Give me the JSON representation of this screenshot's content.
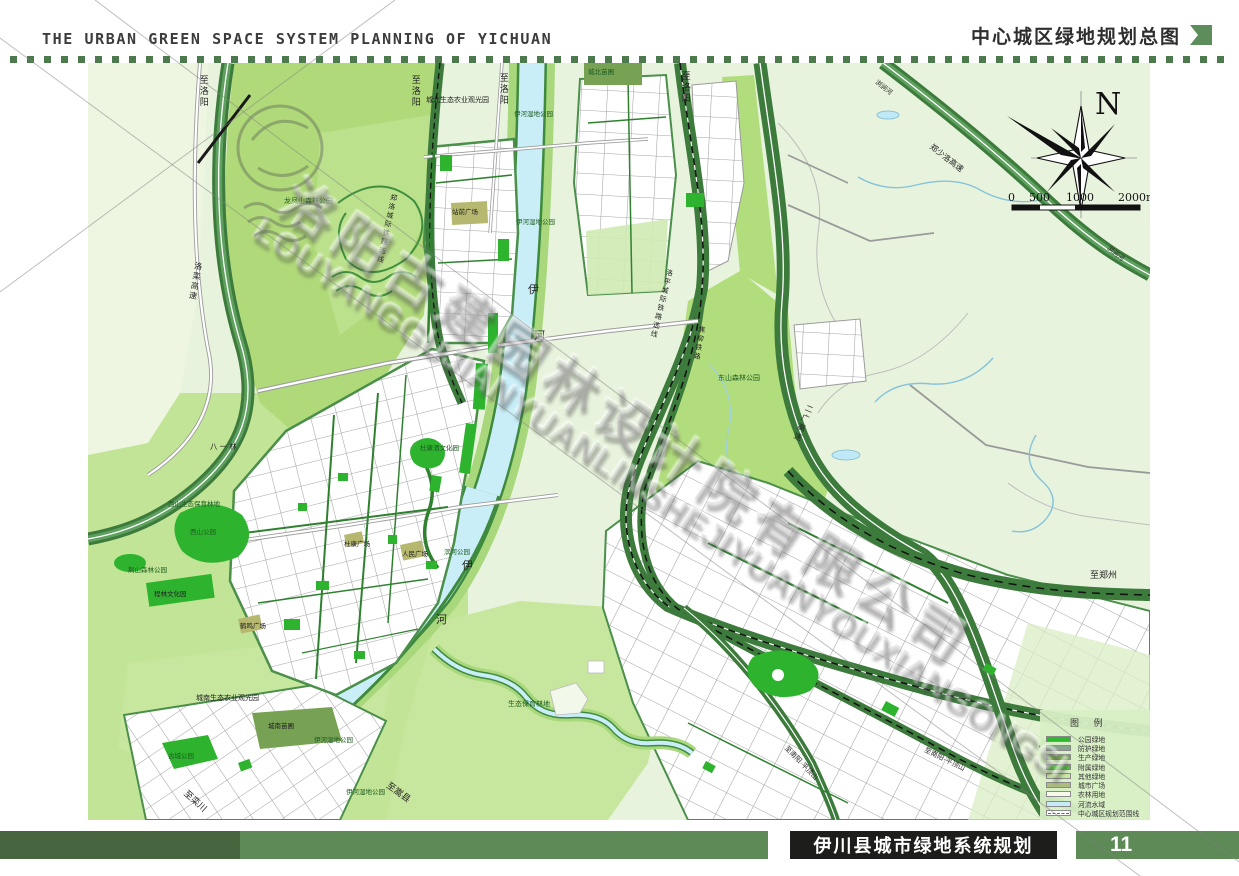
{
  "header": {
    "title_en": "THE URBAN GREEN SPACE SYSTEM PLANNING OF YICHUAN",
    "title_cn": "中心城区绿地规划总图"
  },
  "footer": {
    "title": "伊川县城市绿地系统规划",
    "page_number": "11"
  },
  "compass": {
    "label": "N"
  },
  "scale_bar": {
    "t0": "0",
    "t1": "500",
    "t2": "1000",
    "t3": "2000m"
  },
  "watermark": {
    "text_cn": "洛阳古建园林设计院有限公司",
    "text_en": "LOUYANGGUJIANYUANLINSHEJIYUANYOUXIANGONGSI"
  },
  "legend": {
    "title": "图 例",
    "items": [
      {
        "label": "公园绿地",
        "color": "#2db82f"
      },
      {
        "label": "防护绿地",
        "color": "#86a68b"
      },
      {
        "label": "生产绿地",
        "color": "#77a254"
      },
      {
        "label": "附属绿地",
        "color": "#5bc447"
      },
      {
        "label": "其他绿地",
        "color": "#c9e6a2"
      },
      {
        "label": "城市广场",
        "color": "#abbc80"
      },
      {
        "label": "农林用地",
        "color": "#f7faeb"
      },
      {
        "label": "河流水域",
        "color": "#c5ebf8"
      },
      {
        "label": "中心城区规划范围线",
        "color": "#e03636",
        "type": "line"
      }
    ]
  },
  "map": {
    "labels": [
      {
        "t": "至洛阳",
        "x": 110,
        "y": 12,
        "v": 1,
        "s": 9
      },
      {
        "t": "至洛阳",
        "x": 322,
        "y": 12,
        "v": 1,
        "s": 9
      },
      {
        "t": "至洛阳",
        "x": 410,
        "y": 10,
        "v": 1,
        "s": 9
      },
      {
        "t": "至洛阳",
        "x": 592,
        "y": 8,
        "v": 1,
        "s": 9
      },
      {
        "t": "龙凤山森林公园",
        "x": 196,
        "y": 135,
        "s": 7,
        "c": "g"
      },
      {
        "t": "城北苗圃",
        "x": 500,
        "y": 6,
        "s": 6.5,
        "c": "g"
      },
      {
        "t": "城北生态农业观光园",
        "x": 338,
        "y": 34,
        "s": 7
      },
      {
        "t": "伊河湿地公园",
        "x": 426,
        "y": 48,
        "s": 6.5,
        "c": "g"
      },
      {
        "t": "郑洛城际铁路选线",
        "x": 302,
        "y": 130,
        "v": 1,
        "r": 12,
        "s": 7
      },
      {
        "t": "站前广场",
        "x": 364,
        "y": 146,
        "s": 6.5
      },
      {
        "t": "伊河湿地公园",
        "x": 428,
        "y": 156,
        "s": 6.5,
        "c": "g"
      },
      {
        "t": "伊",
        "x": 440,
        "y": 222,
        "s": 11
      },
      {
        "t": "河",
        "x": 446,
        "y": 268,
        "s": 11
      },
      {
        "t": "洛栾高速",
        "x": 106,
        "y": 198,
        "v": 1,
        "r": 10,
        "s": 8
      },
      {
        "t": "洛平城际铁路选线",
        "x": 578,
        "y": 205,
        "v": 1,
        "r": 14,
        "s": 7
      },
      {
        "t": "焦柳铁路",
        "x": 610,
        "y": 262,
        "v": 1,
        "r": 10,
        "s": 7
      },
      {
        "t": "东山森林公园",
        "x": 630,
        "y": 312,
        "s": 7,
        "c": "g"
      },
      {
        "t": "二广高速",
        "x": 718,
        "y": 340,
        "v": 1,
        "r": 22,
        "s": 8
      },
      {
        "t": "郑少洛高速",
        "x": 845,
        "y": 80,
        "r": 38,
        "s": 8
      },
      {
        "t": "浏涧河",
        "x": 790,
        "y": 16,
        "r": 38,
        "s": 6.5
      },
      {
        "t": "浏涧河",
        "x": 1022,
        "y": 182,
        "r": 38,
        "s": 6.5
      },
      {
        "t": "八 一 林",
        "x": 122,
        "y": 380,
        "s": 7.5
      },
      {
        "t": "西山生态保育林地",
        "x": 80,
        "y": 438,
        "s": 6.5,
        "c": "g"
      },
      {
        "t": "西山公园",
        "x": 102,
        "y": 466,
        "s": 6.5,
        "c": "g"
      },
      {
        "t": "荆山森林公园",
        "x": 40,
        "y": 504,
        "s": 6.5,
        "c": "g"
      },
      {
        "t": "程林文化园",
        "x": 66,
        "y": 528,
        "s": 6.5
      },
      {
        "t": "杜康酒文化园",
        "x": 332,
        "y": 382,
        "s": 6.5,
        "c": "g"
      },
      {
        "t": "杜康广场",
        "x": 256,
        "y": 478,
        "s": 6.5
      },
      {
        "t": "人民广场",
        "x": 314,
        "y": 488,
        "s": 6.5
      },
      {
        "t": "滨河公园",
        "x": 356,
        "y": 486,
        "s": 6.5,
        "c": "g"
      },
      {
        "t": "伊",
        "x": 374,
        "y": 498,
        "s": 11
      },
      {
        "t": "河",
        "x": 348,
        "y": 552,
        "s": 11
      },
      {
        "t": "鹤鸣广场",
        "x": 152,
        "y": 560,
        "s": 6.5
      },
      {
        "t": "城南生态农业观光园",
        "x": 108,
        "y": 632,
        "s": 7
      },
      {
        "t": "城南苗圃",
        "x": 180,
        "y": 660,
        "s": 6.5
      },
      {
        "t": "伊河湿地公园",
        "x": 226,
        "y": 674,
        "s": 6.5,
        "c": "g"
      },
      {
        "t": "伊河湿地公园",
        "x": 258,
        "y": 726,
        "s": 6.5,
        "c": "g"
      },
      {
        "t": "古城公园",
        "x": 80,
        "y": 690,
        "s": 6.5,
        "c": "g"
      },
      {
        "t": "生态保育林地",
        "x": 420,
        "y": 638,
        "s": 7,
        "c": "g"
      },
      {
        "t": "至栾川",
        "x": 100,
        "y": 726,
        "r": 42,
        "s": 9
      },
      {
        "t": "至嵩县",
        "x": 302,
        "y": 718,
        "r": 36,
        "s": 9
      },
      {
        "t": "至郑州",
        "x": 1002,
        "y": 508,
        "s": 9
      },
      {
        "t": "至南阳·平顶山",
        "x": 700,
        "y": 682,
        "r": 46,
        "s": 7
      },
      {
        "t": "至南阳·平顶山",
        "x": 838,
        "y": 684,
        "r": 26,
        "s": 7
      }
    ]
  }
}
